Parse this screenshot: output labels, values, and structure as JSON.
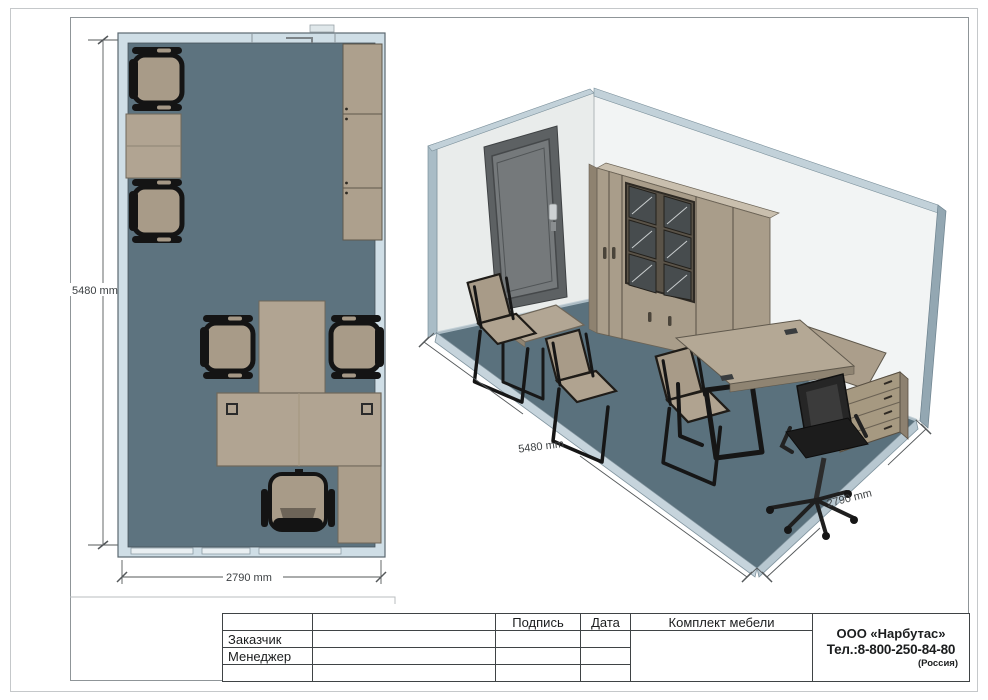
{
  "plan": {
    "dim_vertical": "5480 mm",
    "dim_horizontal": "2790 mm"
  },
  "iso": {
    "dim_left": "5480 mm",
    "dim_right": "2790 mm"
  },
  "title_block": {
    "col_signature": "Подпись",
    "col_date": "Дата",
    "col_set": "Комплект мебели",
    "row_customer": "Заказчик",
    "row_manager": "Менеджер",
    "company_name": "ООО «Нарбутас»",
    "company_phone": "Тел.:8-800-250-84-80",
    "company_country": "(Россия)"
  },
  "colors": {
    "floor": "#5a717d",
    "plan_wall": "#cfdee6",
    "wood": "#ab9f8c",
    "frame_black": "#161616",
    "wall_cap": "#c2d1d9",
    "door_grey": "#5d6163",
    "table_border": "#3f4345"
  }
}
